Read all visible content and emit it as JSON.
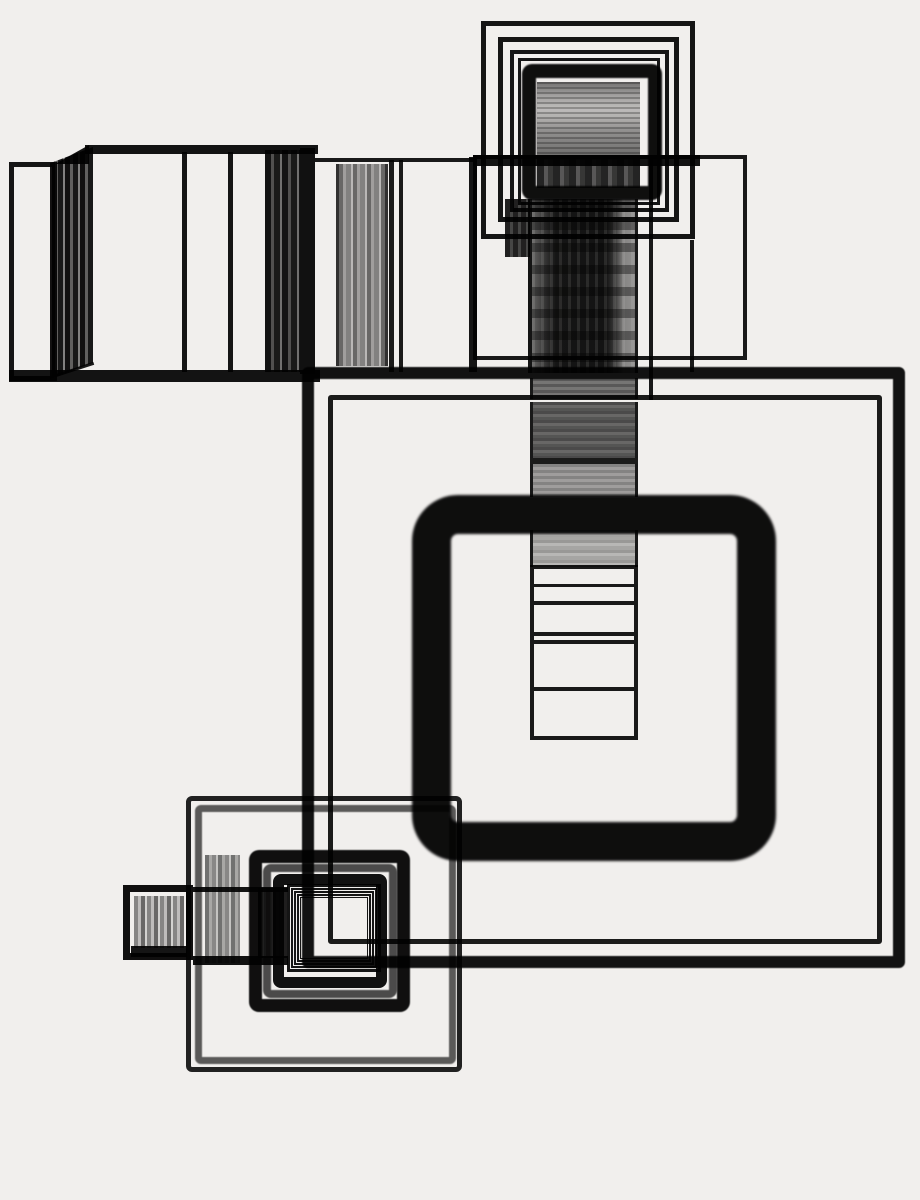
{
  "artwork": {
    "title": "abstract-photogram-nested-squares",
    "width": 920,
    "height": 1200,
    "background_color": "#f1efed",
    "ink_color": "#141414",
    "gray_accent": "#5f5f5f",
    "shapes": [
      {
        "name": "box-left-rect",
        "x": 9,
        "y": 162,
        "w": 48,
        "h": 219,
        "css": {
          "border": "5px solid #161616"
        }
      },
      {
        "name": "box-stripes-left",
        "x": 50,
        "y": 147,
        "w": 43,
        "h": 232,
        "css": {
          "clipPath": "polygon(0 7%,100% 0,100% 93%,0 100%)",
          "background": "repeating-linear-gradient(90deg,#111111 0 5px,#666666 5px 8px,#191919 8px 13px,#8a8a8a 13px 15px)"
        }
      },
      {
        "name": "box-top-fold",
        "x": 55,
        "y": 145,
        "w": 34,
        "h": 19,
        "css": {
          "clipPath": "polygon(0 100%,100% 0,100% 100%)",
          "background": "#141414"
        }
      },
      {
        "name": "box-top-edge",
        "x": 85,
        "y": 145,
        "w": 233,
        "h": 9,
        "css": {
          "background": "#141414"
        }
      },
      {
        "name": "box-divider-a",
        "x": 182,
        "y": 152,
        "w": 5,
        "h": 220,
        "css": {
          "background": "#161616"
        }
      },
      {
        "name": "box-divider-b",
        "x": 228,
        "y": 152,
        "w": 5,
        "h": 220,
        "css": {
          "background": "#161616"
        }
      },
      {
        "name": "box-stripes-right",
        "x": 265,
        "y": 150,
        "w": 35,
        "h": 222,
        "css": {
          "background": "repeating-linear-gradient(90deg,#141414 0 6px,#555555 6px 9px,#1b1b1b 9px 15px,#777777 15px 17px)"
        }
      },
      {
        "name": "box-right-edge",
        "x": 300,
        "y": 148,
        "w": 15,
        "h": 226,
        "css": {
          "background": "#121212"
        }
      },
      {
        "name": "box-bottom-edge",
        "x": 9,
        "y": 370,
        "w": 311,
        "h": 12,
        "css": {
          "background": "#141414"
        }
      },
      {
        "name": "box-bottom-fold-line",
        "x": 50,
        "y": 376,
        "w": 46,
        "h": 3,
        "css": {
          "background": "#1a1a1a",
          "transform": "rotate(-18deg)",
          "transformOrigin": "left center"
        }
      },
      {
        "name": "band-top-line",
        "x": 315,
        "y": 158,
        "w": 160,
        "h": 4,
        "css": {
          "background": "#1a1a1a"
        }
      },
      {
        "name": "band-stripes-column",
        "x": 336,
        "y": 164,
        "w": 52,
        "h": 202,
        "css": {
          "borderLeft": "3px solid #333333",
          "borderRight": "3px solid #333333",
          "background": "repeating-linear-gradient(90deg,#6e6e6e 0 4px,#a9a9a9 4px 7px,#8a8a8a 7px 12px,#c4c4c4 12px 14px)"
        }
      },
      {
        "name": "band-divider-390",
        "x": 389,
        "y": 160,
        "w": 5,
        "h": 212,
        "css": {
          "background": "#1c1c1c"
        }
      },
      {
        "name": "band-divider-400",
        "x": 399,
        "y": 160,
        "w": 4,
        "h": 212,
        "css": {
          "background": "#1c1c1c"
        }
      },
      {
        "name": "band-divider-470",
        "x": 469,
        "y": 157,
        "w": 8,
        "h": 215,
        "css": {
          "background": "#161616"
        }
      },
      {
        "name": "band-wide-rect",
        "x": 473,
        "y": 155,
        "w": 274,
        "h": 205,
        "css": {
          "border": "4px solid #1a1a1a"
        }
      },
      {
        "name": "band-wide-rect-top-thick",
        "x": 473,
        "y": 155,
        "w": 227,
        "h": 11,
        "css": {
          "background": "#141414"
        }
      },
      {
        "name": "band-divider-651",
        "x": 649,
        "y": 155,
        "w": 4,
        "h": 245,
        "css": {
          "background": "#1a1a1a"
        }
      },
      {
        "name": "band-divider-692",
        "x": 690,
        "y": 240,
        "w": 4,
        "h": 132,
        "css": {
          "background": "#1a1a1a"
        }
      },
      {
        "name": "top-nest-square-1",
        "x": 481,
        "y": 21,
        "w": 214,
        "h": 218,
        "css": {
          "border": "5px solid #161616"
        }
      },
      {
        "name": "top-nest-square-2",
        "x": 498,
        "y": 37,
        "w": 181,
        "h": 185,
        "css": {
          "border": "5px solid #161616"
        }
      },
      {
        "name": "top-nest-square-3",
        "x": 510,
        "y": 50,
        "w": 159,
        "h": 162,
        "css": {
          "border": "4px solid #161616"
        }
      },
      {
        "name": "top-nest-square-4",
        "x": 518,
        "y": 58,
        "w": 142,
        "h": 147,
        "css": {
          "border": "3px solid #161616"
        }
      },
      {
        "name": "top-inner-stripes",
        "x": 537,
        "y": 82,
        "w": 103,
        "h": 78,
        "css": {
          "background": "repeating-linear-gradient(180deg,rgba(0,0,0,0.25) 0 2px,rgba(255,255,255,0) 2px 5px),linear-gradient(180deg,#7a7a7a 0%,#adadad 18%,#c9c9c9 34%,#bdbdbd 45%,#9a9a9a 62%,#868686 80%,#6f6f6f 100%)"
        }
      },
      {
        "name": "top-inner-dark-row",
        "x": 537,
        "y": 158,
        "w": 103,
        "h": 30,
        "css": {
          "background": "repeating-linear-gradient(90deg,#262626 0 7px,#5d5d5d 7px 11px,#3a3a3a 11px 16px)"
        }
      },
      {
        "name": "top-thick-square",
        "x": 522,
        "y": 64,
        "w": 140,
        "h": 136,
        "css": {
          "border": "14px solid #0f0f0f",
          "borderRadius": "10px",
          "filter": "blur(0.8px)"
        }
      },
      {
        "name": "column-streak-left",
        "x": 505,
        "y": 199,
        "w": 25,
        "h": 58,
        "css": {
          "background": "repeating-linear-gradient(90deg,#222222 0 5px,#4a4a4a 5px 8px)"
        }
      },
      {
        "name": "column-dark-upper",
        "x": 528,
        "y": 199,
        "w": 110,
        "h": 174,
        "css": {
          "borderLeft": "4px solid #151515",
          "borderRight": "3px solid #1a1a1a",
          "background": "repeating-linear-gradient(180deg,rgba(0,0,0,0.38) 0 9px,rgba(0,0,0,0) 9px 22px),repeating-linear-gradient(90deg,rgba(255,255,255,0.10) 0 3px,rgba(255,255,255,0) 3px 9px),linear-gradient(90deg,#6a6a6a 0px,#2e2e2e 16px,#161616 24px,#141414 74px,#3f3f3f 83px,#8f8f8f 92px,#999999 103px)"
        }
      },
      {
        "name": "column-stripe-seg-1",
        "x": 530,
        "y": 378,
        "w": 108,
        "h": 21,
        "css": {
          "borderLeft": "3px solid #1a1a1a",
          "borderRight": "3px solid #1a1a1a",
          "background": "repeating-linear-gradient(180deg,#5e5e5e 0 3px,#7d7d7d 3px 6px)"
        }
      },
      {
        "name": "column-stripe-seg-2",
        "x": 530,
        "y": 402,
        "w": 108,
        "h": 56,
        "css": {
          "borderLeft": "3px solid #1a1a1a",
          "borderRight": "3px solid #1a1a1a",
          "background": "repeating-linear-gradient(180deg,#4f4f4f 0 3px,#6e6e6e 3px 6px,#5a5a5a 6px 9px)"
        }
      },
      {
        "name": "column-rule-458",
        "x": 530,
        "y": 458,
        "w": 108,
        "h": 6,
        "css": {
          "background": "#1c1c1c"
        }
      },
      {
        "name": "column-stripe-seg-3",
        "x": 530,
        "y": 464,
        "w": 108,
        "h": 33,
        "css": {
          "borderLeft": "3px solid #1a1a1a",
          "borderRight": "3px solid #1a1a1a",
          "background": "repeating-linear-gradient(180deg,#8c8c8c 0 3px,#a8a8a8 3px 6px)"
        }
      },
      {
        "name": "column-stripe-seg-4",
        "x": 530,
        "y": 530,
        "w": 108,
        "h": 37,
        "css": {
          "borderLeft": "3px solid #1a1a1a",
          "borderRight": "3px solid #1a1a1a",
          "background": "repeating-linear-gradient(180deg,#a2a2a2 0 3px,#c3c3c3 3px 6px,#b0b0b0 6px 10px)"
        }
      },
      {
        "name": "column-ruled-rows",
        "x": 530,
        "y": 565,
        "w": 108,
        "h": 175,
        "css": {
          "border": "4px solid #1a1a1a"
        }
      },
      {
        "name": "column-row-line-585",
        "x": 534,
        "y": 584,
        "w": 100,
        "h": 3,
        "css": {
          "background": "#1a1a1a"
        }
      },
      {
        "name": "column-row-line-602",
        "x": 534,
        "y": 601,
        "w": 100,
        "h": 4,
        "css": {
          "background": "#1a1a1a"
        }
      },
      {
        "name": "column-row-line-633",
        "x": 534,
        "y": 632,
        "w": 100,
        "h": 4,
        "css": {
          "background": "#1a1a1a"
        }
      },
      {
        "name": "column-row-line-641",
        "x": 534,
        "y": 640,
        "w": 100,
        "h": 4,
        "css": {
          "background": "#1a1a1a"
        }
      },
      {
        "name": "column-row-line-688",
        "x": 534,
        "y": 687,
        "w": 100,
        "h": 4,
        "css": {
          "background": "#1a1a1a"
        }
      },
      {
        "name": "big-outline-square",
        "x": 302,
        "y": 367,
        "w": 603,
        "h": 601,
        "css": {
          "border": "12px solid #131313",
          "borderRadius": "6px",
          "filter": "blur(0.5px)"
        }
      },
      {
        "name": "inner-outline-square",
        "x": 328,
        "y": 395,
        "w": 554,
        "h": 549,
        "css": {
          "border": "5px solid #1c1c1c",
          "borderRadius": "3px"
        }
      },
      {
        "name": "thick-rounded-square",
        "x": 412,
        "y": 495,
        "w": 364,
        "h": 366,
        "css": {
          "border": "39px solid #0e0e0e",
          "borderRadius": "46px",
          "filter": "blur(1.2px)"
        }
      },
      {
        "name": "cluster-outer-square",
        "x": 186,
        "y": 796,
        "w": 276,
        "h": 276,
        "css": {
          "border": "5px solid #232323",
          "borderRadius": "6px"
        }
      },
      {
        "name": "cluster-outer-gray-square",
        "x": 195,
        "y": 805,
        "w": 261,
        "h": 259,
        "css": {
          "border": "7px solid #5f5f5f",
          "borderRadius": "6px",
          "filter": "blur(0.5px)"
        }
      },
      {
        "name": "cluster-medium-square",
        "x": 249,
        "y": 850,
        "w": 161,
        "h": 162,
        "css": {
          "border": "13px solid #101010",
          "borderRadius": "10px",
          "filter": "blur(0.6px)"
        }
      },
      {
        "name": "cluster-gray-square",
        "x": 263,
        "y": 864,
        "w": 134,
        "h": 134,
        "css": {
          "border": "8px solid #4f4f4f",
          "borderRadius": "8px",
          "filter": "blur(0.6px)"
        }
      },
      {
        "name": "cluster-black-square",
        "x": 273,
        "y": 874,
        "w": 114,
        "h": 114,
        "css": {
          "border": "11px solid #121212",
          "borderRadius": "8px"
        }
      },
      {
        "name": "cluster-thin-square-1",
        "x": 287,
        "y": 884,
        "w": 94,
        "h": 88,
        "css": {
          "border": "3px solid #161616"
        }
      },
      {
        "name": "cluster-thin-square-2",
        "x": 291,
        "y": 888,
        "w": 86,
        "h": 80,
        "css": {
          "border": "2px solid #161616"
        }
      },
      {
        "name": "cluster-thin-square-3",
        "x": 294,
        "y": 891,
        "w": 80,
        "h": 74,
        "css": {
          "border": "2px solid #161616"
        }
      },
      {
        "name": "cluster-thin-square-4",
        "x": 297,
        "y": 894,
        "w": 74,
        "h": 68,
        "css": {
          "border": "2px solid #161616"
        }
      },
      {
        "name": "cluster-thin-square-5",
        "x": 300,
        "y": 897,
        "w": 68,
        "h": 62,
        "css": {
          "border": "1px solid #161616"
        }
      },
      {
        "name": "small-striped-square",
        "x": 123,
        "y": 885,
        "w": 70,
        "h": 75,
        "css": {
          "border": "7px solid #101010"
        }
      },
      {
        "name": "small-square-stripes",
        "x": 134,
        "y": 896,
        "w": 50,
        "h": 52,
        "css": {
          "background": "repeating-linear-gradient(90deg,#8e8e8e 0 4px,#c9c9c9 4px 7px,#6f6f6f 7px 11px,#e0e0e0 11px 13px)"
        }
      },
      {
        "name": "small-square-bottom-fill",
        "x": 131,
        "y": 946,
        "w": 56,
        "h": 11,
        "css": {
          "background": "#161616"
        }
      },
      {
        "name": "small-band-top-edge",
        "x": 193,
        "y": 887,
        "w": 95,
        "h": 5,
        "css": {
          "background": "#161616"
        }
      },
      {
        "name": "small-band-bottom-edge",
        "x": 193,
        "y": 956,
        "w": 95,
        "h": 9,
        "css": {
          "background": "#131313"
        }
      },
      {
        "name": "small-band-stripes-1",
        "x": 205,
        "y": 855,
        "w": 35,
        "h": 108,
        "css": {
          "background": "repeating-linear-gradient(90deg,#787878 0 4px,#b2b2b2 4px 7px,#909090 7px 11px,#d0d0d0 11px 13px)"
        }
      },
      {
        "name": "small-band-stripes-2",
        "x": 258,
        "y": 888,
        "w": 29,
        "h": 70,
        "css": {
          "background": "repeating-linear-gradient(90deg,#202020 0 5px,#4a4a4a 5px 8px,#303030 8px 13px)"
        }
      }
    ]
  }
}
